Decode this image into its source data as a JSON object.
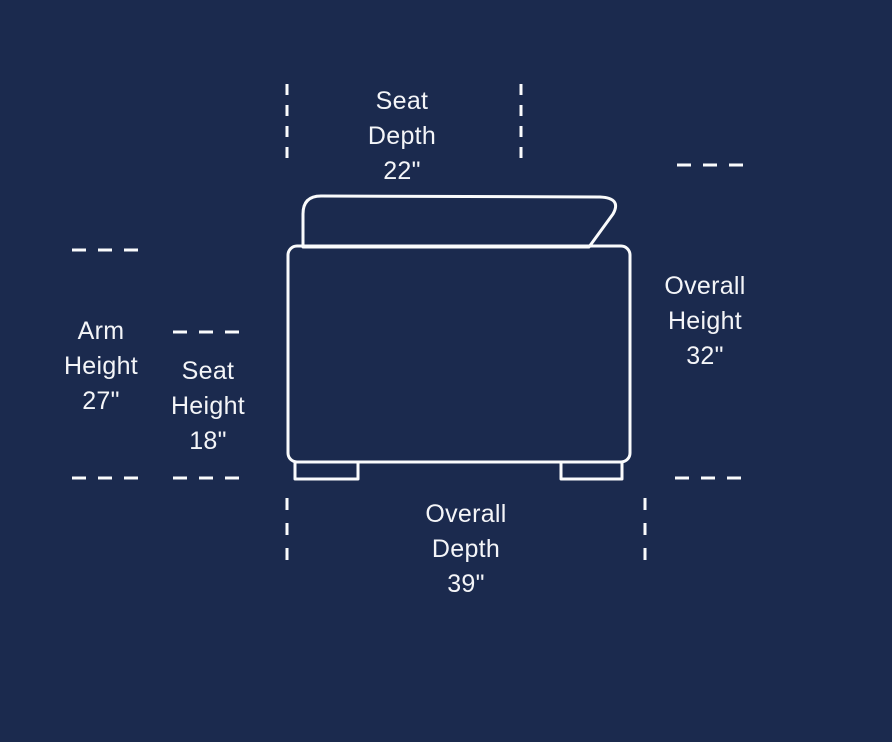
{
  "colors": {
    "background": "#1B2A4E",
    "line": "#FAFBFC",
    "text": "#F4F5F8"
  },
  "labels": {
    "seat_depth": {
      "line1": "Seat",
      "line2": "Depth",
      "value": "22\""
    },
    "arm_height": {
      "line1": "Arm",
      "line2": "Height",
      "value": "27\""
    },
    "seat_height": {
      "line1": "Seat",
      "line2": "Height",
      "value": "18\""
    },
    "overall_height": {
      "line1": "Overall",
      "line2": "Height",
      "value": "32\""
    },
    "overall_depth": {
      "line1": "Overall",
      "line2": "Depth",
      "value": "39\""
    }
  }
}
